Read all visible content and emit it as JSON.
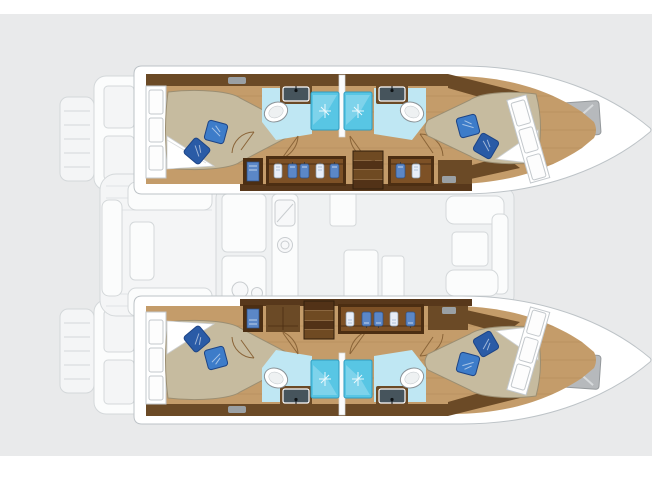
{
  "palette": {
    "bg": "#e9eaeb",
    "band": "#ffffff",
    "fade-fill": "#f4f5f6",
    "fade-line": "#d4d8da",
    "fade-white": "#fbfcfc",
    "salon-fill": "#eff1f2",
    "rim-line": "#bdc3c7",
    "wood": "#c49c6a",
    "plank": "#a57e4c",
    "trim": "#6b4a26",
    "trim-dark": "#4c2e12",
    "wardrobe": "#7d5126",
    "mattress": "#c6bb9f",
    "mattress-line": "#9b8e72",
    "pillow": "#3d7cc9",
    "pillow-dark": "#2a5ba6",
    "bath-floor": "#bfe7f3",
    "shower": "#58c6e4",
    "shower-light": "#9fdff0",
    "shower-line": "#2f9cc0",
    "toilet-line": "#8b9398",
    "sink-basin": "#46545c",
    "hatch": "#b6b9bc",
    "hatch-line": "#94989b",
    "stair-a": "#6f4a22",
    "stair-b": "#523217",
    "clothes-blue": "#5b87c7",
    "clothes-white": "#e8eef8",
    "door-line": "#8a6438",
    "vent": "#9aa0a4"
  },
  "diagram": {
    "type": "boat-floorplan",
    "vessel": "catamaran",
    "orientation": "bow-right",
    "highlighted_level": "hull-accommodation",
    "faded_level": "deck-saloon-silhouette",
    "totals": {
      "cabins": 4,
      "bathrooms": 4,
      "shower_stalls": 4,
      "toilets": 4,
      "sinks": 4,
      "beds": 4,
      "pillows_per_bed": 2,
      "companionway_stairs": 2,
      "bow_hatches": 2
    },
    "hulls": [
      {
        "id": "port-hull-top",
        "cabins": [
          {
            "name": "aft-double-cabin",
            "features": [
              "island-bed",
              "blue-pillows",
              "hull-windows",
              "wood-floor"
            ]
          },
          {
            "name": "forward-double-cabin",
            "features": [
              "island-bed",
              "blue-pillows",
              "hull-windows",
              "wood-floor"
            ]
          }
        ],
        "bathrooms": [
          {
            "name": "aft-bathroom",
            "fixtures": [
              "toilet",
              "sink",
              "shower-stall"
            ]
          },
          {
            "name": "forward-bathroom",
            "fixtures": [
              "toilet",
              "sink",
              "shower-stall"
            ]
          }
        ],
        "corridor": {
          "lockers": 1,
          "wardrobes_with_clothes": 2,
          "stairs": 1,
          "stairs_position": "forward-of-center"
        }
      },
      {
        "id": "starboard-hull-bottom",
        "cabins": [
          {
            "name": "aft-double-cabin",
            "features": [
              "island-bed",
              "blue-pillows",
              "hull-windows",
              "wood-floor"
            ]
          },
          {
            "name": "forward-double-cabin",
            "features": [
              "island-bed",
              "blue-pillows",
              "hull-windows",
              "wood-floor"
            ]
          }
        ],
        "bathrooms": [
          {
            "name": "aft-bathroom",
            "fixtures": [
              "toilet",
              "sink",
              "shower-stall"
            ]
          },
          {
            "name": "forward-bathroom",
            "fixtures": [
              "toilet",
              "sink",
              "shower-stall"
            ]
          }
        ],
        "corridor": {
          "lockers": 2,
          "wardrobes_with_clothes": 1,
          "stairs": 1,
          "stairs_position": "aft-of-center"
        }
      }
    ],
    "faded_areas": [
      "stern-swim-platforms",
      "aft-deck",
      "aft-cockpit-benches",
      "saloon-galley",
      "saloon-table",
      "forward-cockpit-seating",
      "bow-decks"
    ]
  }
}
